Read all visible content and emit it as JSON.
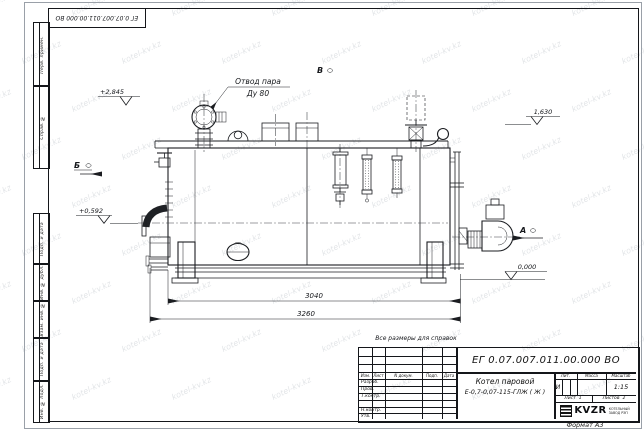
{
  "watermark": {
    "text": "kotel-kv.kz"
  },
  "colors": {
    "line": "#1b1d21",
    "paper": "#ffffff",
    "watermark": "#9ba3ad"
  },
  "frame": {
    "top_stamp": "ЕГ 0.07.007.011.00.000  ВО",
    "format_label": "Формат А3",
    "margin_labels": [
      "Перв. примен.",
      "Справ. №",
      "Подп. и дата",
      "Инв. № дубл.",
      "Взам. инв. №",
      "Подп. и дата",
      "Инв. № подл."
    ]
  },
  "drawing": {
    "callout": {
      "line1": "Отвод пара",
      "line2": "Ду 80"
    },
    "note": "Все размеры для справок",
    "view_markers": {
      "b": "Б",
      "v": "В",
      "a": "А"
    },
    "elevations": {
      "top": "+2,845",
      "shell_top": "1,630",
      "burner_axis": "+0,592",
      "ground": "0,000"
    },
    "dimensions": {
      "shell_length": "3040",
      "overall_length": "3260"
    }
  },
  "title_block": {
    "designation": "ЕГ 0.07.007.011.00.000  ВО",
    "product_name": "Котел паровой",
    "product_model": "Е-0,7-0,07-115-ГЛЖ ( Ж )",
    "header_cols": [
      "Изм.",
      "Лист",
      "N докум.",
      "Подп.",
      "Дата"
    ],
    "sign_rows": [
      "Разраб.",
      "Пров.",
      "Т.контр.",
      "",
      "Н.контр.",
      "Утв."
    ],
    "lit_label": "Лит.",
    "lit_value": "И",
    "mass_label": "Масса",
    "mass_value": "",
    "scale_label": "Масштаб",
    "scale_value": "1:15",
    "sheet_label": "Лист",
    "sheet_value": "1",
    "sheets_label": "Листов",
    "sheets_value": "2",
    "company_logo": "KVZR",
    "company_line1": "КОТЕЛЬНЫЙ",
    "company_line2": "ЗАВОД РЭП"
  }
}
